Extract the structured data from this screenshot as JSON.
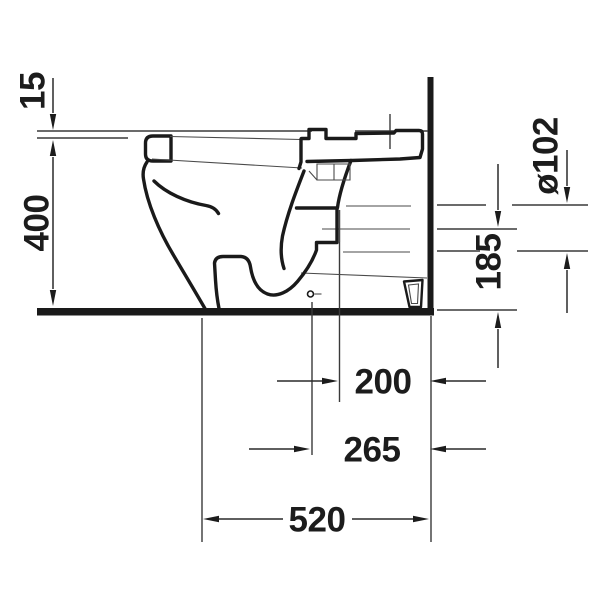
{
  "drawing": {
    "kind": "technical-dimension-drawing",
    "subject": "floor-standing close-coupled toilet, side elevation with wall and floor",
    "unit": "mm",
    "background_color": "#ffffff",
    "line_color": "#1a1a1a",
    "dimensions": [
      {
        "id": "seat-thickness",
        "label": "15",
        "orientation": "vertical",
        "meaning": "seat/lid top above ceramic rim"
      },
      {
        "id": "rim-height",
        "label": "400",
        "orientation": "vertical",
        "meaning": "floor to rim height"
      },
      {
        "id": "outlet-diameter",
        "label": "ø102",
        "orientation": "vertical",
        "meaning": "outlet pipe diameter"
      },
      {
        "id": "outlet-centre-height",
        "label": "185",
        "orientation": "vertical",
        "meaning": "floor to outlet centre"
      },
      {
        "id": "setout-200",
        "label": "200",
        "orientation": "horizontal",
        "meaning": "wall to outlet"
      },
      {
        "id": "setout-265",
        "label": "265",
        "orientation": "horizontal",
        "meaning": "wall to drain centre"
      },
      {
        "id": "depth",
        "label": "520",
        "orientation": "horizontal",
        "meaning": "overall depth from wall"
      }
    ]
  }
}
